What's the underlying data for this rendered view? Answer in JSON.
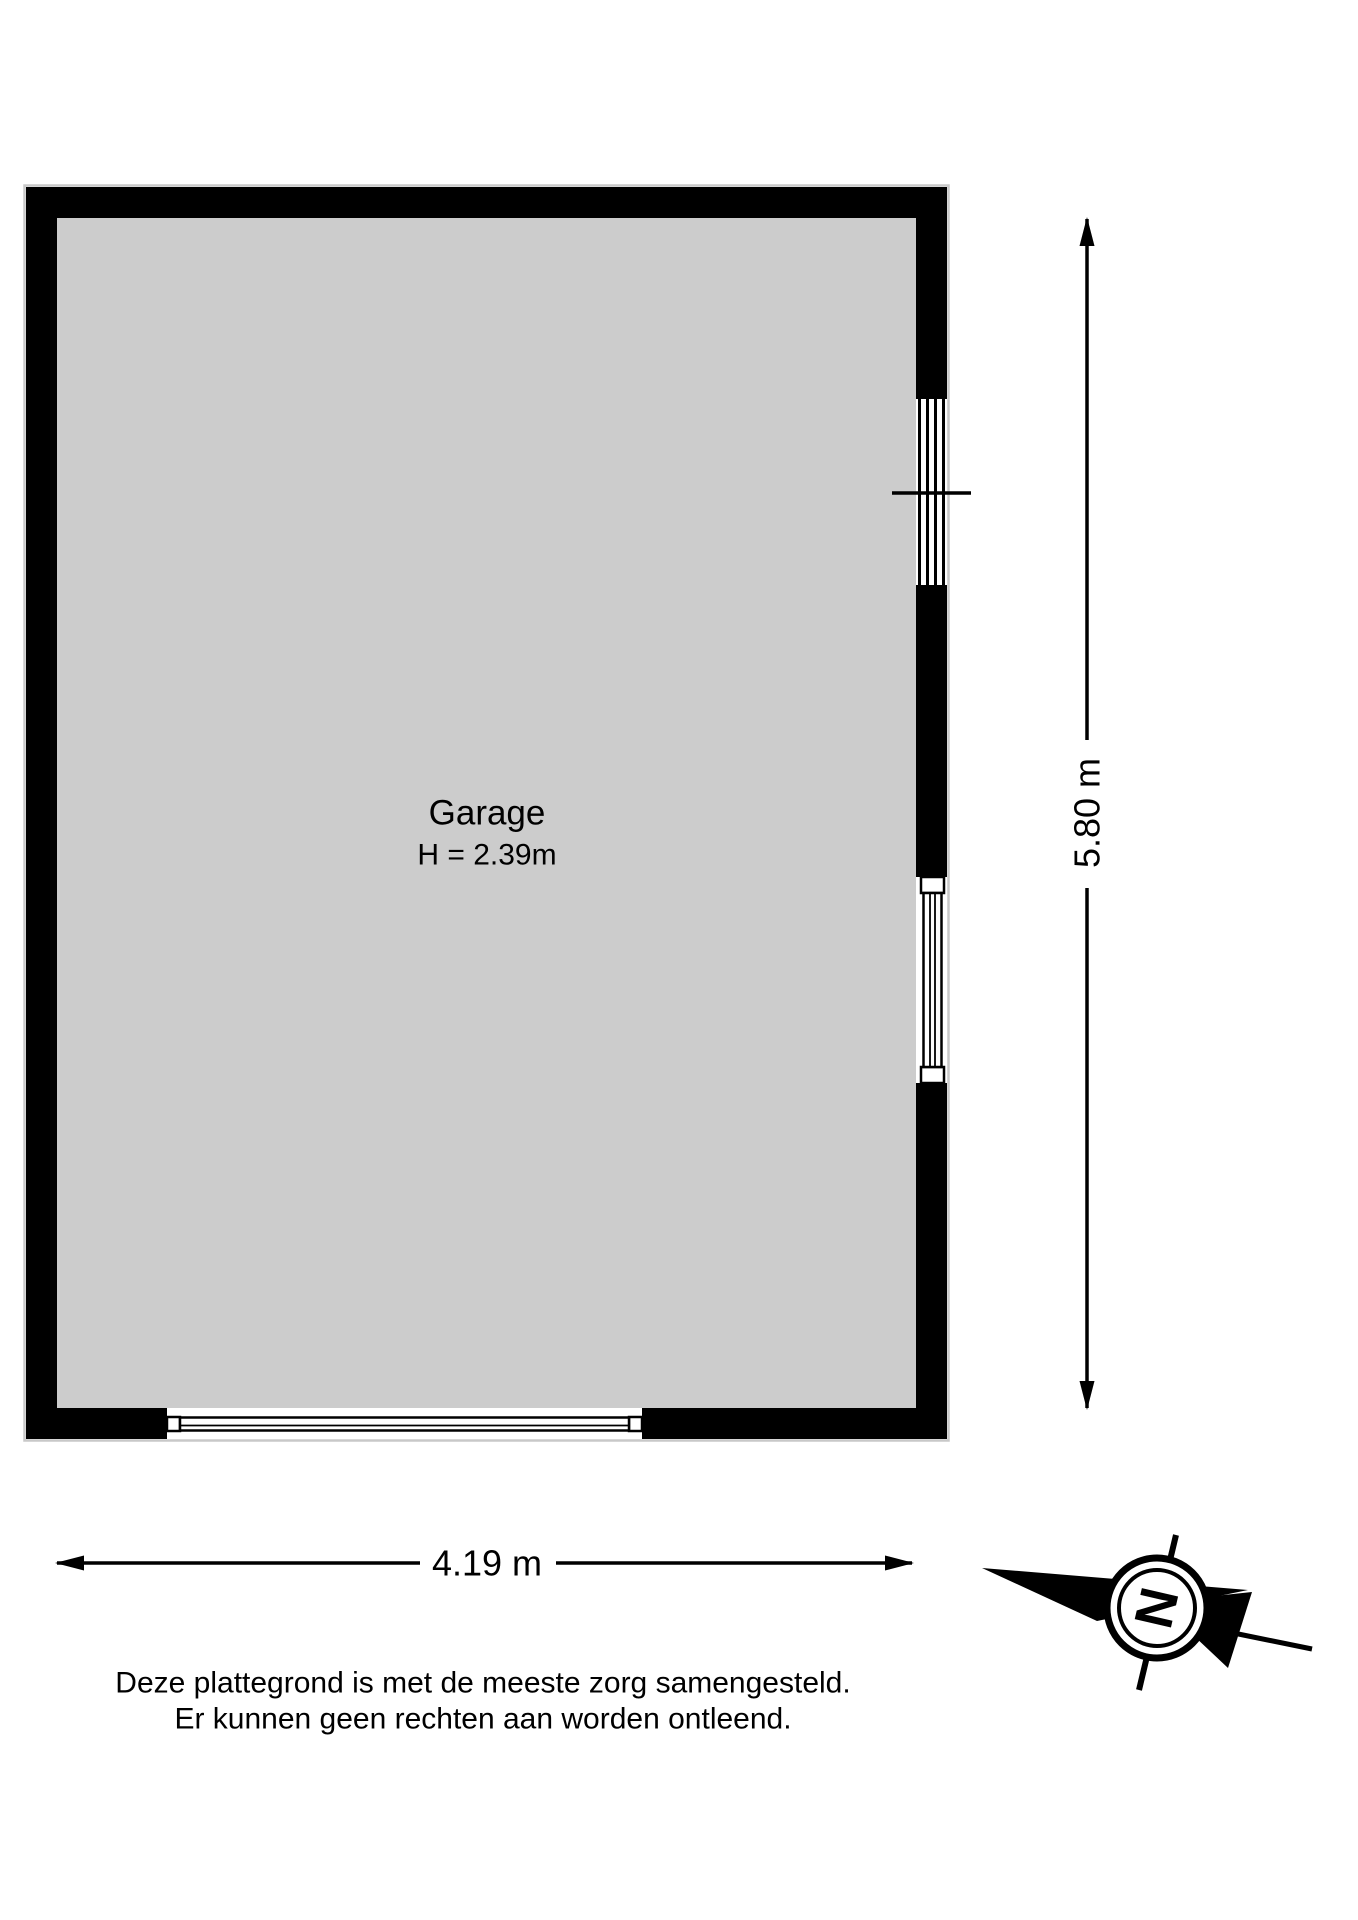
{
  "plan": {
    "room": {
      "name": "Garage",
      "ceiling_height": "H = 2.39m"
    },
    "dimensions": {
      "width_label": "4.19 m",
      "height_label": "5.80 m"
    },
    "compass": {
      "north_label": "N"
    }
  },
  "footer": {
    "disclaimer_line1": "Deze plattegrond is met de meeste zorg samengesteld.",
    "disclaimer_line2": "Er kunnen geen rechten aan worden ontleend."
  },
  "colors": {
    "wall": "#000000",
    "floor": "#cccccc",
    "background": "#ffffff",
    "line": "#000000"
  }
}
